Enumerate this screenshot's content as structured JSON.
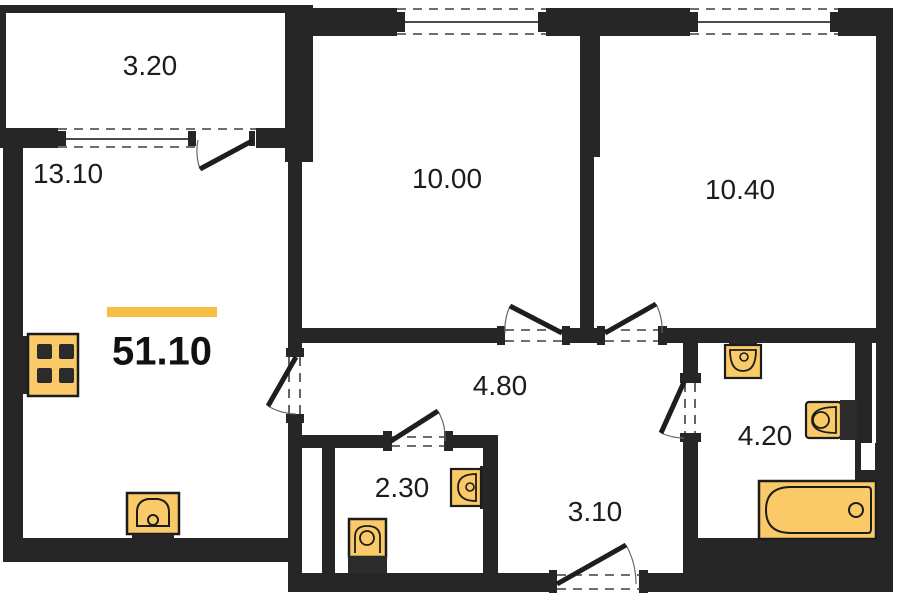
{
  "plan": {
    "title": "apartment-floor-plan",
    "total_area_label": "51.10",
    "rooms": [
      {
        "name": "balcony",
        "area_label": "3.20"
      },
      {
        "name": "kitchen-living-room",
        "area_label": "13.10"
      },
      {
        "name": "bedroom-1",
        "area_label": "10.00"
      },
      {
        "name": "bedroom-2",
        "area_label": "10.40"
      },
      {
        "name": "corridor",
        "area_label": "4.80"
      },
      {
        "name": "wc",
        "area_label": "2.30"
      },
      {
        "name": "entrance-hall",
        "area_label": "3.10"
      },
      {
        "name": "bathroom",
        "area_label": "4.20"
      }
    ],
    "fixtures": [
      {
        "icon": "stove-icon"
      },
      {
        "icon": "kitchen-sink-icon"
      },
      {
        "icon": "wc-toilet-icon"
      },
      {
        "icon": "wc-sink-icon"
      },
      {
        "icon": "bathroom-sink-icon"
      },
      {
        "icon": "bathroom-toilet-icon"
      },
      {
        "icon": "bathtub-icon"
      }
    ],
    "colors": {
      "walls": "#262626",
      "fixtures": "#f9ca67",
      "accent_bar": "#f5bd41",
      "background": "#ffffff"
    }
  }
}
